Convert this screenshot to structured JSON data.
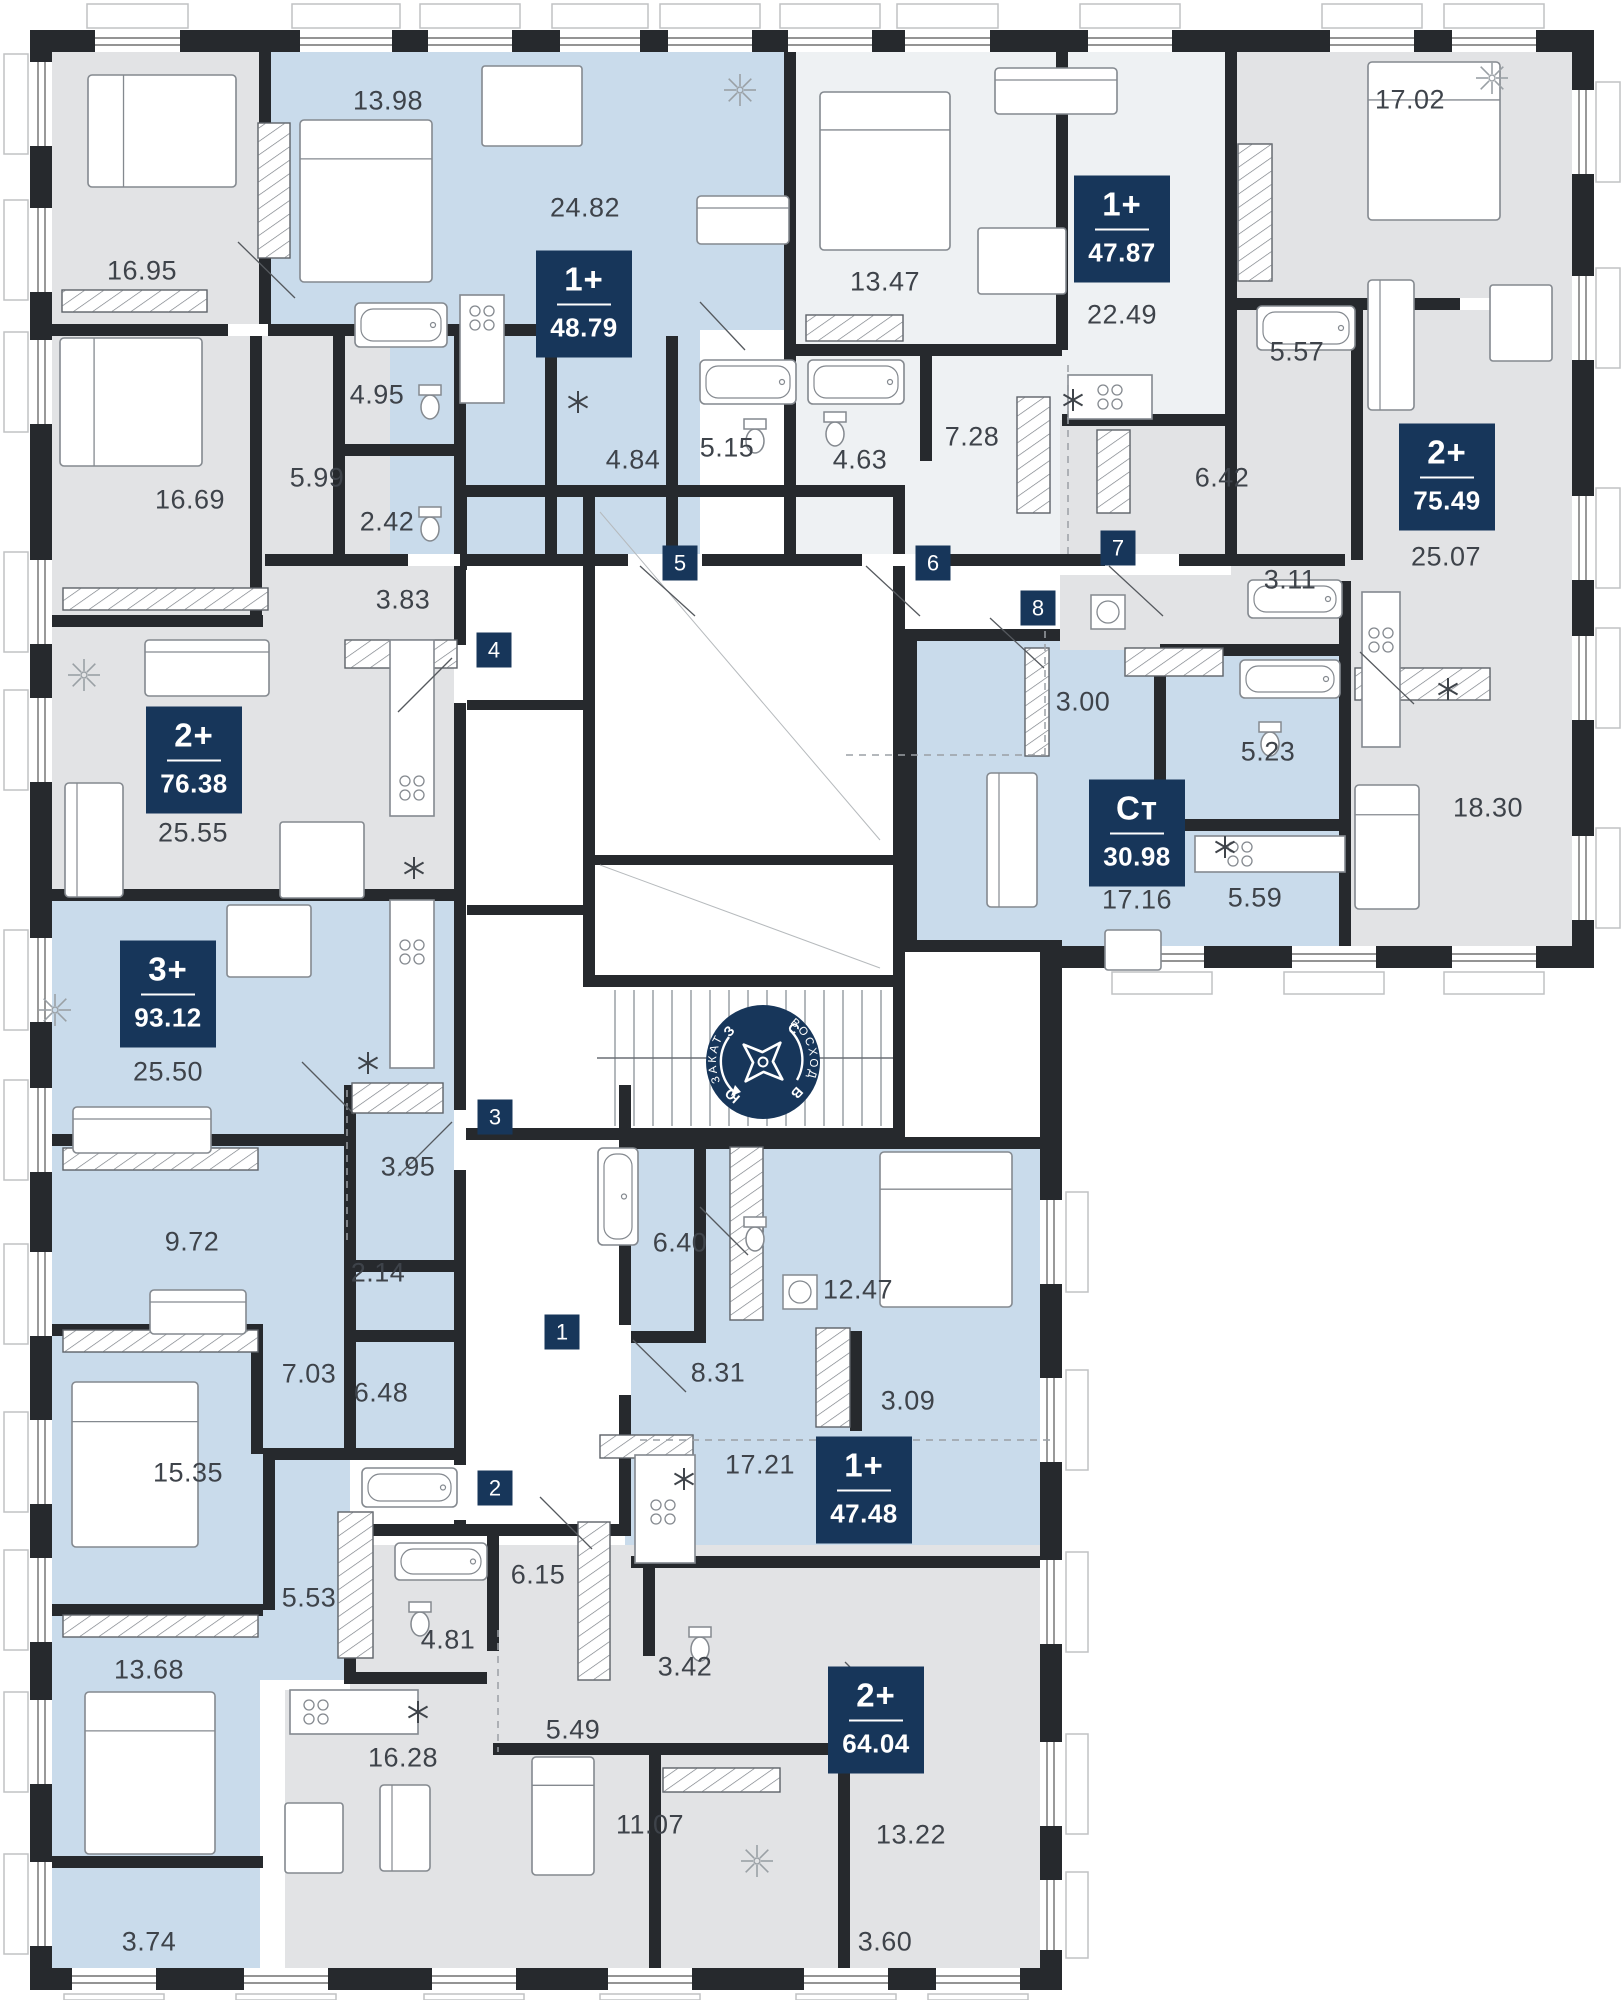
{
  "plan": {
    "width": 1624,
    "height": 2000
  },
  "colors": {
    "wall": "#26292d",
    "badge_navy": "#17365a",
    "room_blue": "#c9dbeb",
    "room_gray": "#e2e3e5",
    "room_pale": "#eef1f3",
    "corridor_white": "#ffffff",
    "label_text": "#3e434a"
  },
  "apartments": [
    {
      "type": "1+",
      "area": "48.79",
      "x": 584,
      "y": 304
    },
    {
      "type": "1+",
      "area": "47.87",
      "x": 1122,
      "y": 229
    },
    {
      "type": "2+",
      "area": "75.49",
      "x": 1447,
      "y": 477
    },
    {
      "type": "2+",
      "area": "76.38",
      "x": 194,
      "y": 760
    },
    {
      "type": "3+",
      "area": "93.12",
      "x": 168,
      "y": 994
    },
    {
      "type": "Ст",
      "area": "30.98",
      "x": 1137,
      "y": 833
    },
    {
      "type": "1+",
      "area": "47.48",
      "x": 864,
      "y": 1490
    },
    {
      "type": "2+",
      "area": "64.04",
      "x": 876,
      "y": 1720
    }
  ],
  "room_labels": [
    {
      "t": "16.95",
      "x": 142,
      "y": 271
    },
    {
      "t": "13.98",
      "x": 388,
      "y": 101
    },
    {
      "t": "24.82",
      "x": 585,
      "y": 208
    },
    {
      "t": "4.95",
      "x": 377,
      "y": 395
    },
    {
      "t": "5.99",
      "x": 317,
      "y": 478
    },
    {
      "t": "16.69",
      "x": 190,
      "y": 500
    },
    {
      "t": "2.42",
      "x": 387,
      "y": 522
    },
    {
      "t": "3.83",
      "x": 403,
      "y": 600
    },
    {
      "t": "4.84",
      "x": 633,
      "y": 460
    },
    {
      "t": "5.15",
      "x": 727,
      "y": 448
    },
    {
      "t": "13.47",
      "x": 885,
      "y": 282
    },
    {
      "t": "4.63",
      "x": 860,
      "y": 460
    },
    {
      "t": "7.28",
      "x": 972,
      "y": 437
    },
    {
      "t": "22.49",
      "x": 1122,
      "y": 315
    },
    {
      "t": "17.02",
      "x": 1410,
      "y": 100
    },
    {
      "t": "5.57",
      "x": 1297,
      "y": 352
    },
    {
      "t": "6.42",
      "x": 1222,
      "y": 478
    },
    {
      "t": "3.11",
      "x": 1290,
      "y": 580
    },
    {
      "t": "25.07",
      "x": 1446,
      "y": 557
    },
    {
      "t": "25.55",
      "x": 193,
      "y": 833
    },
    {
      "t": "3.00",
      "x": 1083,
      "y": 702
    },
    {
      "t": "5.23",
      "x": 1268,
      "y": 752
    },
    {
      "t": "5.59",
      "x": 1255,
      "y": 898
    },
    {
      "t": "17.16",
      "x": 1137,
      "y": 900
    },
    {
      "t": "18.30",
      "x": 1488,
      "y": 808
    },
    {
      "t": "25.50",
      "x": 168,
      "y": 1072
    },
    {
      "t": "3.95",
      "x": 408,
      "y": 1167
    },
    {
      "t": "9.72",
      "x": 192,
      "y": 1242
    },
    {
      "t": "2.14",
      "x": 378,
      "y": 1273
    },
    {
      "t": "7.03",
      "x": 309,
      "y": 1374
    },
    {
      "t": "6.48",
      "x": 381,
      "y": 1393
    },
    {
      "t": "15.35",
      "x": 188,
      "y": 1473
    },
    {
      "t": "5.53",
      "x": 309,
      "y": 1598
    },
    {
      "t": "13.68",
      "x": 149,
      "y": 1670
    },
    {
      "t": "3.74",
      "x": 149,
      "y": 1942
    },
    {
      "t": "6.40",
      "x": 680,
      "y": 1243
    },
    {
      "t": "12.47",
      "x": 858,
      "y": 1290
    },
    {
      "t": "8.31",
      "x": 718,
      "y": 1373
    },
    {
      "t": "3.09",
      "x": 908,
      "y": 1401
    },
    {
      "t": "17.21",
      "x": 760,
      "y": 1465
    },
    {
      "t": "6.15",
      "x": 538,
      "y": 1575
    },
    {
      "t": "4.81",
      "x": 448,
      "y": 1640
    },
    {
      "t": "3.42",
      "x": 685,
      "y": 1667
    },
    {
      "t": "5.49",
      "x": 573,
      "y": 1730
    },
    {
      "t": "16.28",
      "x": 403,
      "y": 1758
    },
    {
      "t": "11.07",
      "x": 650,
      "y": 1825
    },
    {
      "t": "13.22",
      "x": 911,
      "y": 1835
    },
    {
      "t": "3.60",
      "x": 885,
      "y": 1942
    }
  ],
  "entry_markers": [
    {
      "n": "1",
      "x": 562,
      "y": 1332
    },
    {
      "n": "2",
      "x": 495,
      "y": 1488
    },
    {
      "n": "3",
      "x": 495,
      "y": 1117
    },
    {
      "n": "4",
      "x": 494,
      "y": 650
    },
    {
      "n": "5",
      "x": 680,
      "y": 563
    },
    {
      "n": "6",
      "x": 933,
      "y": 563
    },
    {
      "n": "7",
      "x": 1118,
      "y": 548
    },
    {
      "n": "8",
      "x": 1038,
      "y": 608
    }
  ],
  "compass": {
    "sunset": "ЗАКАТ",
    "sunrise": "ВОСХОД",
    "north": "С",
    "east": "В",
    "south": "Ю",
    "west": "З"
  }
}
